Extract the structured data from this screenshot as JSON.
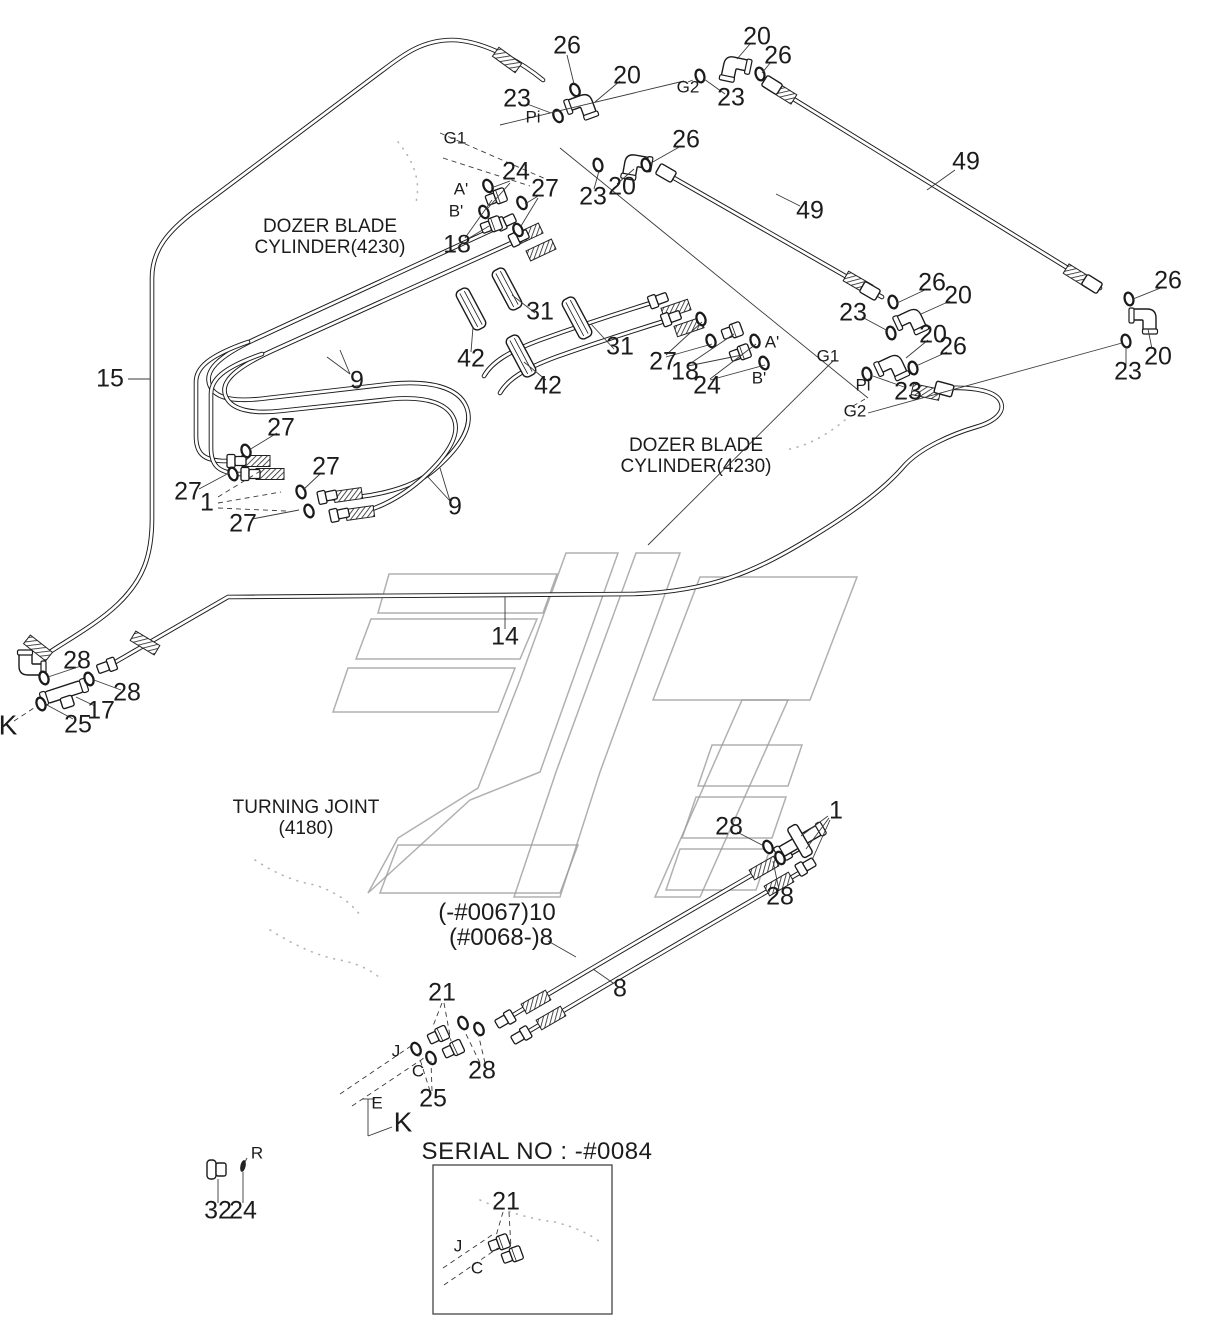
{
  "drawing": {
    "accent_color": "#1a1a1a",
    "watermark_color": "#9c9c9c",
    "notes": {
      "dozer_blade_cylinder_1": "DOZER BLADE\nCYLINDER(4230)",
      "dozer_blade_cylinder_2": "DOZER BLADE\nCYLINDER(4230)",
      "turning_joint": "TURNING JOINT\n(4180)",
      "serial_heading": "SERIAL NO : -#0084",
      "hose_variant_early": "(-#0067)10",
      "hose_variant_late": "(#0068-)8"
    },
    "labels": [
      {
        "t": "26",
        "x": 567,
        "y": 46,
        "k": "num"
      },
      {
        "t": "20",
        "x": 627,
        "y": 76,
        "k": "num"
      },
      {
        "t": "23",
        "x": 517,
        "y": 99,
        "k": "num"
      },
      {
        "t": "Pi",
        "x": 533,
        "y": 118,
        "k": "ref"
      },
      {
        "t": "20",
        "x": 757,
        "y": 37,
        "k": "num"
      },
      {
        "t": "26",
        "x": 778,
        "y": 56,
        "k": "num"
      },
      {
        "t": "G2",
        "x": 688,
        "y": 88,
        "k": "ref"
      },
      {
        "t": "23",
        "x": 731,
        "y": 98,
        "k": "num"
      },
      {
        "t": "26",
        "x": 686,
        "y": 140,
        "k": "num"
      },
      {
        "t": "20",
        "x": 622,
        "y": 187,
        "k": "num"
      },
      {
        "t": "23",
        "x": 593,
        "y": 197,
        "k": "num"
      },
      {
        "t": "49",
        "x": 966,
        "y": 162,
        "k": "num"
      },
      {
        "t": "49",
        "x": 810,
        "y": 211,
        "k": "num"
      },
      {
        "t": "G1",
        "x": 455,
        "y": 139,
        "k": "ref"
      },
      {
        "t": "A'",
        "x": 461,
        "y": 190,
        "k": "ref"
      },
      {
        "t": "B'",
        "x": 456,
        "y": 212,
        "k": "ref"
      },
      {
        "t": "24",
        "x": 516,
        "y": 172,
        "k": "num"
      },
      {
        "t": "27",
        "x": 545,
        "y": 189,
        "k": "num"
      },
      {
        "t": "18",
        "x": 457,
        "y": 245,
        "k": "num"
      },
      {
        "t": "DOZER BLADE\nCYLINDER(4230)",
        "x": 330,
        "y": 238,
        "k": "note",
        "n": "note-dozer-blade-cylinder-1"
      },
      {
        "t": "15",
        "x": 110,
        "y": 379,
        "k": "num"
      },
      {
        "t": "31",
        "x": 540,
        "y": 312,
        "k": "num"
      },
      {
        "t": "42",
        "x": 471,
        "y": 359,
        "k": "num"
      },
      {
        "t": "31",
        "x": 620,
        "y": 347,
        "k": "num"
      },
      {
        "t": "42",
        "x": 548,
        "y": 386,
        "k": "num"
      },
      {
        "t": "9",
        "x": 357,
        "y": 381,
        "k": "num"
      },
      {
        "t": "9",
        "x": 455,
        "y": 507,
        "k": "num"
      },
      {
        "t": "27",
        "x": 663,
        "y": 362,
        "k": "num"
      },
      {
        "t": "18",
        "x": 685,
        "y": 372,
        "k": "num"
      },
      {
        "t": "24",
        "x": 707,
        "y": 386,
        "k": "num"
      },
      {
        "t": "A'",
        "x": 772,
        "y": 343,
        "k": "ref"
      },
      {
        "t": "B'",
        "x": 759,
        "y": 379,
        "k": "ref"
      },
      {
        "t": "DOZER BLADE\nCYLINDER(4230)",
        "x": 696,
        "y": 457,
        "k": "note",
        "n": "note-dozer-blade-cylinder-2"
      },
      {
        "t": "26",
        "x": 932,
        "y": 283,
        "k": "num"
      },
      {
        "t": "20",
        "x": 958,
        "y": 296,
        "k": "num"
      },
      {
        "t": "23",
        "x": 853,
        "y": 313,
        "k": "num"
      },
      {
        "t": "20",
        "x": 933,
        "y": 335,
        "k": "num"
      },
      {
        "t": "26",
        "x": 953,
        "y": 347,
        "k": "num"
      },
      {
        "t": "G1",
        "x": 828,
        "y": 357,
        "k": "ref"
      },
      {
        "t": "Pi",
        "x": 863,
        "y": 386,
        "k": "ref"
      },
      {
        "t": "23",
        "x": 908,
        "y": 392,
        "k": "num"
      },
      {
        "t": "G2",
        "x": 855,
        "y": 412,
        "k": "ref"
      },
      {
        "t": "26",
        "x": 1168,
        "y": 281,
        "k": "num"
      },
      {
        "t": "20",
        "x": 1158,
        "y": 357,
        "k": "num"
      },
      {
        "t": "23",
        "x": 1128,
        "y": 372,
        "k": "num"
      },
      {
        "t": "27",
        "x": 281,
        "y": 428,
        "k": "num"
      },
      {
        "t": "27",
        "x": 188,
        "y": 492,
        "k": "num"
      },
      {
        "t": "1",
        "x": 207,
        "y": 503,
        "k": "num"
      },
      {
        "t": "27",
        "x": 243,
        "y": 524,
        "k": "num"
      },
      {
        "t": "27",
        "x": 326,
        "y": 467,
        "k": "num"
      },
      {
        "t": "28",
        "x": 77,
        "y": 661,
        "k": "num"
      },
      {
        "t": "28",
        "x": 127,
        "y": 693,
        "k": "num"
      },
      {
        "t": "17",
        "x": 101,
        "y": 711,
        "k": "num"
      },
      {
        "t": "25",
        "x": 78,
        "y": 725,
        "k": "num"
      },
      {
        "t": "K",
        "x": 8,
        "y": 726,
        "k": "big"
      },
      {
        "t": "14",
        "x": 505,
        "y": 637,
        "k": "num"
      },
      {
        "t": "TURNING JOINT\n(4180)",
        "x": 306,
        "y": 819,
        "k": "note",
        "n": "note-turning-joint"
      },
      {
        "t": "1",
        "x": 836,
        "y": 811,
        "k": "num"
      },
      {
        "t": "28",
        "x": 729,
        "y": 827,
        "k": "num"
      },
      {
        "t": "28",
        "x": 780,
        "y": 897,
        "k": "num"
      },
      {
        "t": "(-#0067)10",
        "x": 497,
        "y": 913,
        "k": "variant",
        "n": "hose-variant-early"
      },
      {
        "t": "(#0068-)8",
        "x": 501,
        "y": 938,
        "k": "variant",
        "n": "hose-variant-late"
      },
      {
        "t": "8",
        "x": 620,
        "y": 989,
        "k": "num"
      },
      {
        "t": "21",
        "x": 442,
        "y": 993,
        "k": "num"
      },
      {
        "t": "28",
        "x": 482,
        "y": 1071,
        "k": "num"
      },
      {
        "t": "25",
        "x": 433,
        "y": 1099,
        "k": "num"
      },
      {
        "t": "J",
        "x": 396,
        "y": 1052,
        "k": "ref"
      },
      {
        "t": "C",
        "x": 418,
        "y": 1072,
        "k": "ref"
      },
      {
        "t": "E",
        "x": 377,
        "y": 1104,
        "k": "ref"
      },
      {
        "t": "K",
        "x": 403,
        "y": 1123,
        "k": "big"
      },
      {
        "t": "R",
        "x": 257,
        "y": 1154,
        "k": "ref"
      },
      {
        "t": "32",
        "x": 218,
        "y": 1211,
        "k": "num"
      },
      {
        "t": "24",
        "x": 243,
        "y": 1211,
        "k": "num"
      },
      {
        "t": "SERIAL NO : -#0084",
        "x": 537,
        "y": 1152,
        "k": "serial",
        "n": "serial-no-heading"
      },
      {
        "t": "21",
        "x": 506,
        "y": 1202,
        "k": "num"
      },
      {
        "t": "J",
        "x": 458,
        "y": 1247,
        "k": "ref"
      },
      {
        "t": "C",
        "x": 477,
        "y": 1269,
        "k": "ref"
      }
    ]
  }
}
